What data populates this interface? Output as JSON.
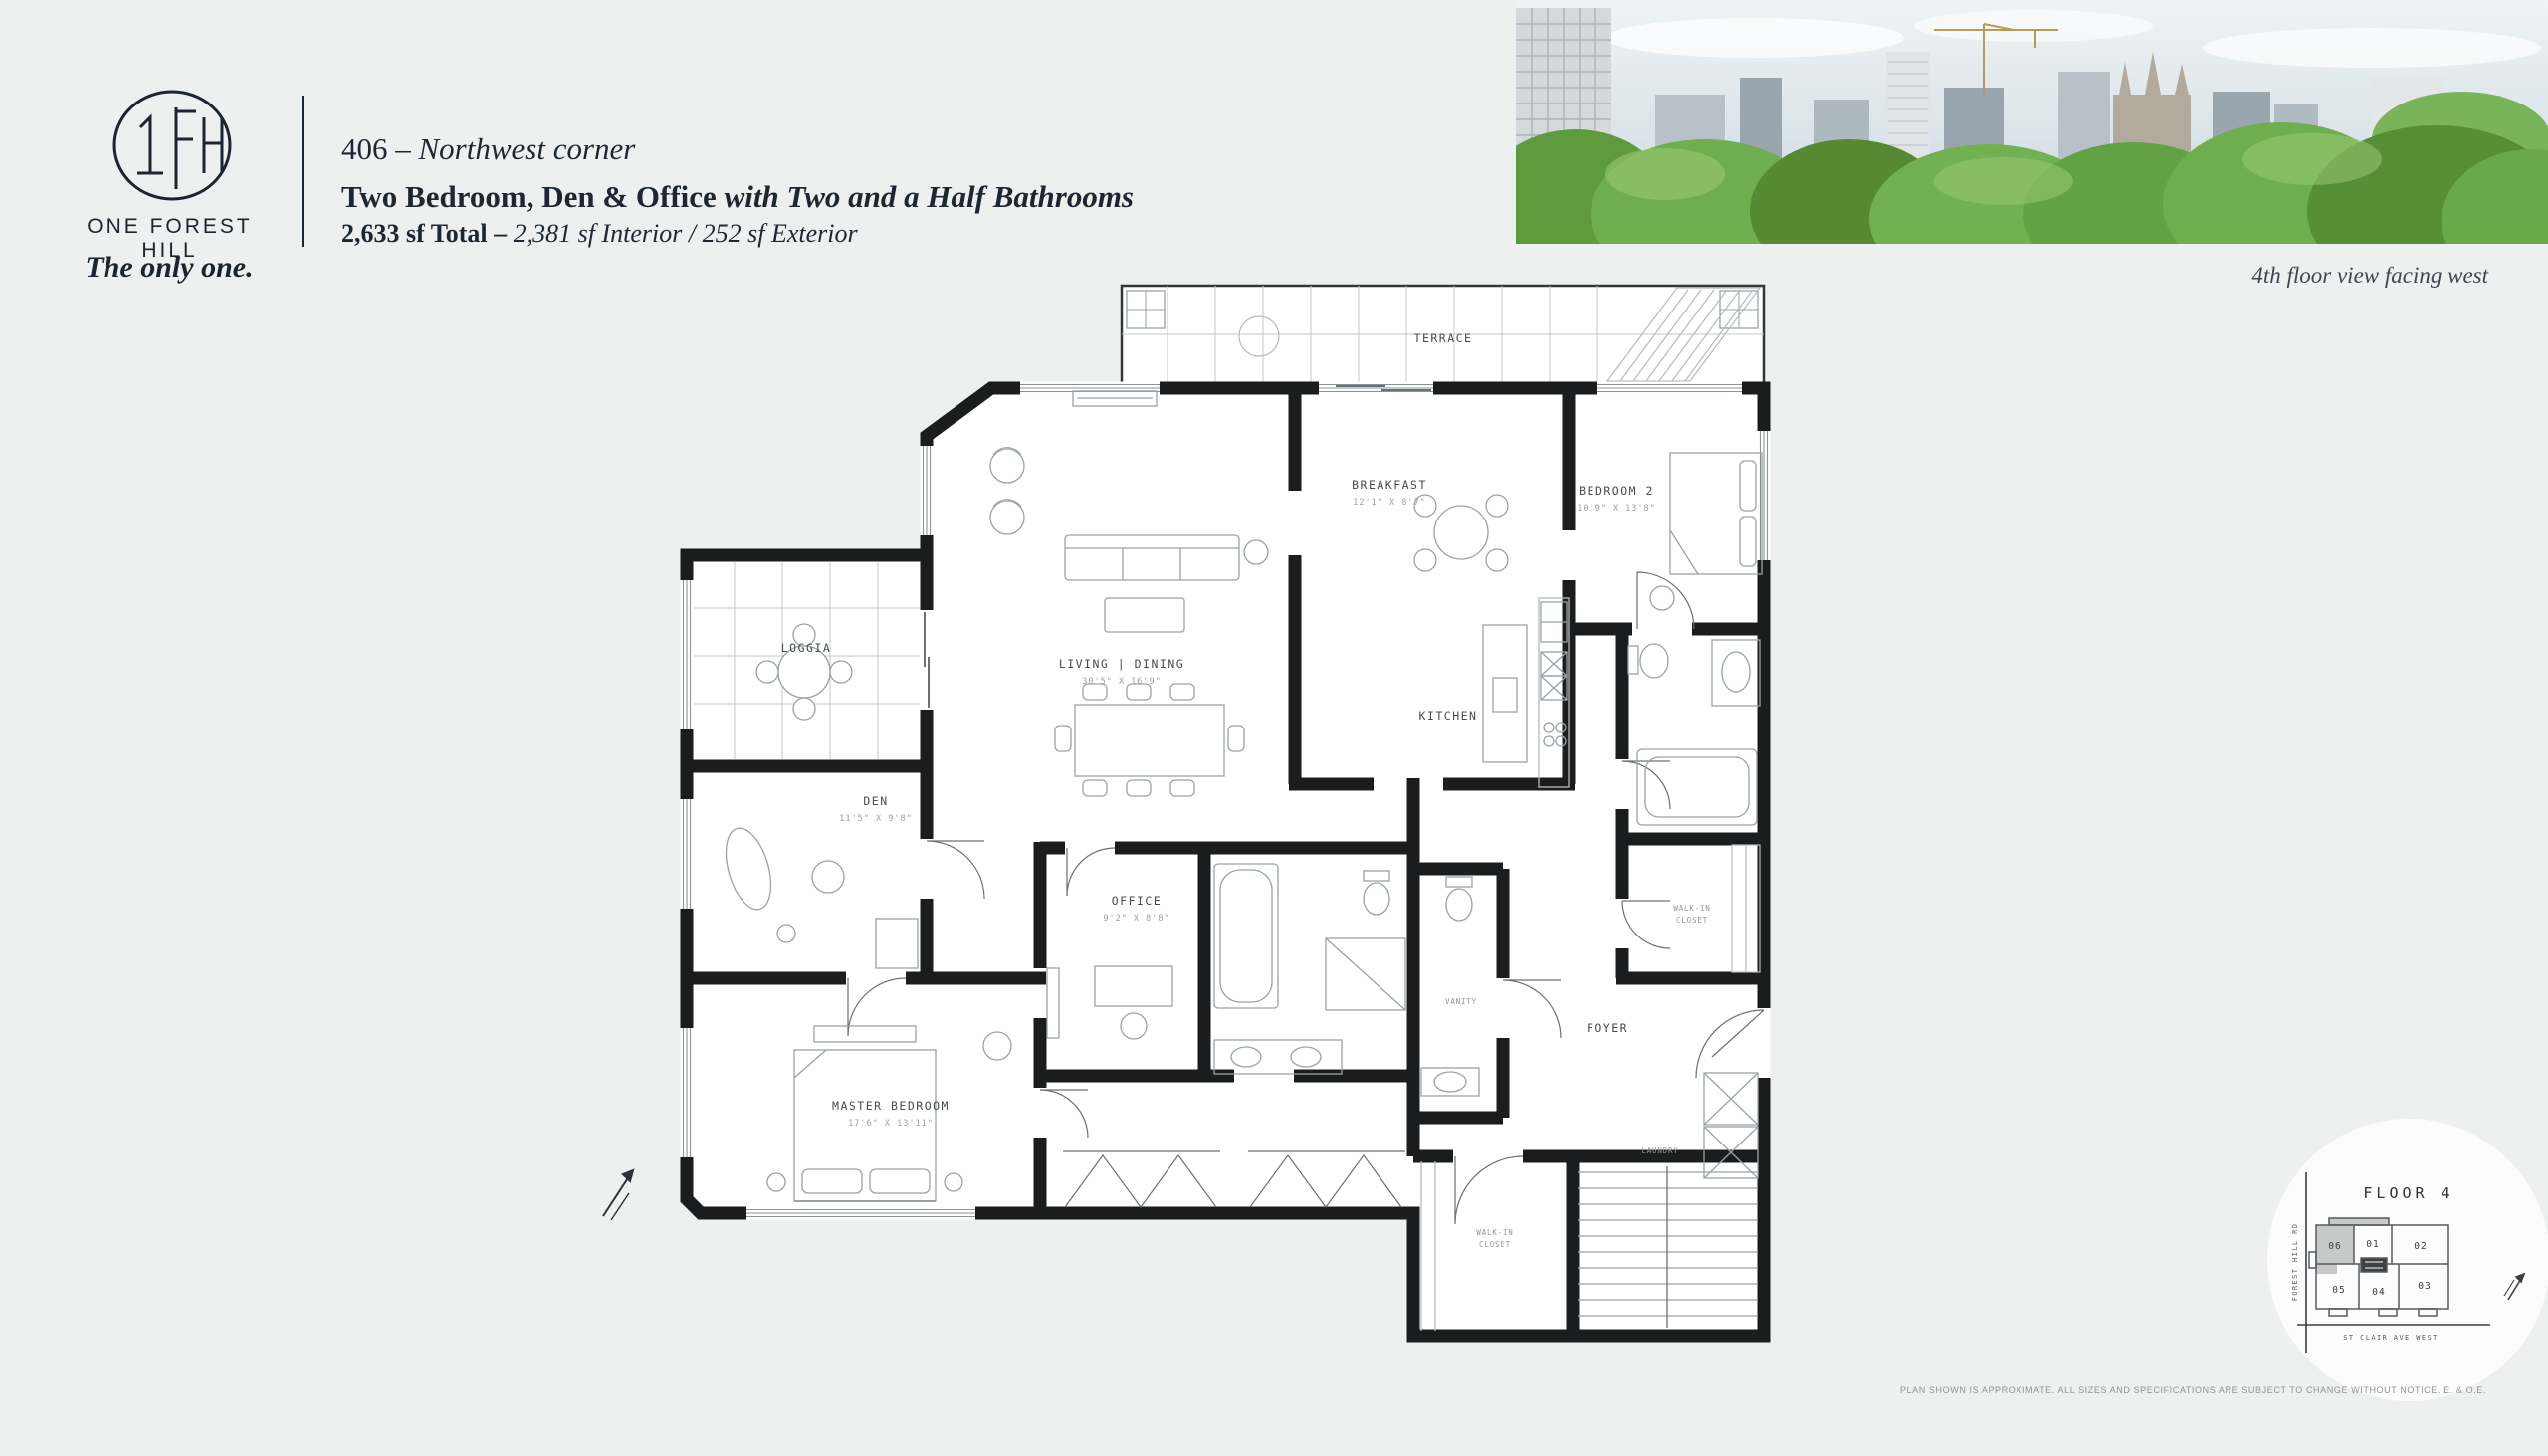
{
  "brand": {
    "monogram": "1FH",
    "name": "ONE FOREST HILL",
    "tagline": "The only one."
  },
  "header": {
    "unit": "406",
    "separator": "–",
    "orientation": "Northwest corner",
    "title": "Two Bedroom, Den & Office ",
    "title_suffix": "with Two and a Half Bathrooms",
    "area_total": "2,633 sf Total – ",
    "area_detail": "2,381 sf Interior / 252 sf Exterior"
  },
  "photo": {
    "caption": "4th floor view facing west"
  },
  "plan": {
    "rooms": {
      "terrace": {
        "label": "TERRACE"
      },
      "living": {
        "label": "LIVING | DINING",
        "dims": "30'5\" X 16'9\""
      },
      "breakfast": {
        "label": "BREAKFAST",
        "dims": "12'1\" X 8'7\""
      },
      "bedroom2": {
        "label": "BEDROOM 2",
        "dims": "10'9\" X 13'8\""
      },
      "kitchen": {
        "label": "KITCHEN"
      },
      "loggia": {
        "label": "LOGGIA"
      },
      "den": {
        "label": "DEN",
        "dims": "11'5\" X 9'8\""
      },
      "office": {
        "label": "OFFICE",
        "dims": "9'2\" X 8'8\""
      },
      "master": {
        "label": "MASTER BEDROOM",
        "dims": "17'6\" X 13'11\""
      },
      "foyer": {
        "label": "FOYER"
      },
      "wic1_line1": "WALK-IN",
      "wic1_line2": "CLOSET",
      "wic2_line1": "WALK-IN",
      "wic2_line2": "CLOSET",
      "laundry": "LAUNDRY",
      "vanity": "VANITY"
    }
  },
  "keyplan": {
    "title": "FLOOR 4",
    "units": [
      {
        "id": "06",
        "highlighted": true
      },
      {
        "id": "01",
        "highlighted": false
      },
      {
        "id": "02",
        "highlighted": false
      },
      {
        "id": "05",
        "highlighted": false
      },
      {
        "id": "04",
        "highlighted": false
      },
      {
        "id": "03",
        "highlighted": false
      }
    ],
    "street_left": "FOREST HILL RD",
    "street_bottom": "ST CLAIR AVE WEST"
  },
  "footer": {
    "disclaimer": "PLAN SHOWN IS APPROXIMATE. ALL SIZES AND SPECIFICATIONS ARE SUBJECT TO CHANGE WITHOUT NOTICE. E. & O.E."
  },
  "colors": {
    "background": "#edf0ee",
    "ink": "#1d2733",
    "plan_wall": "#1b1c1e",
    "highlight_unit": "#c6c9c8",
    "tree_green": "#6fae4e"
  }
}
